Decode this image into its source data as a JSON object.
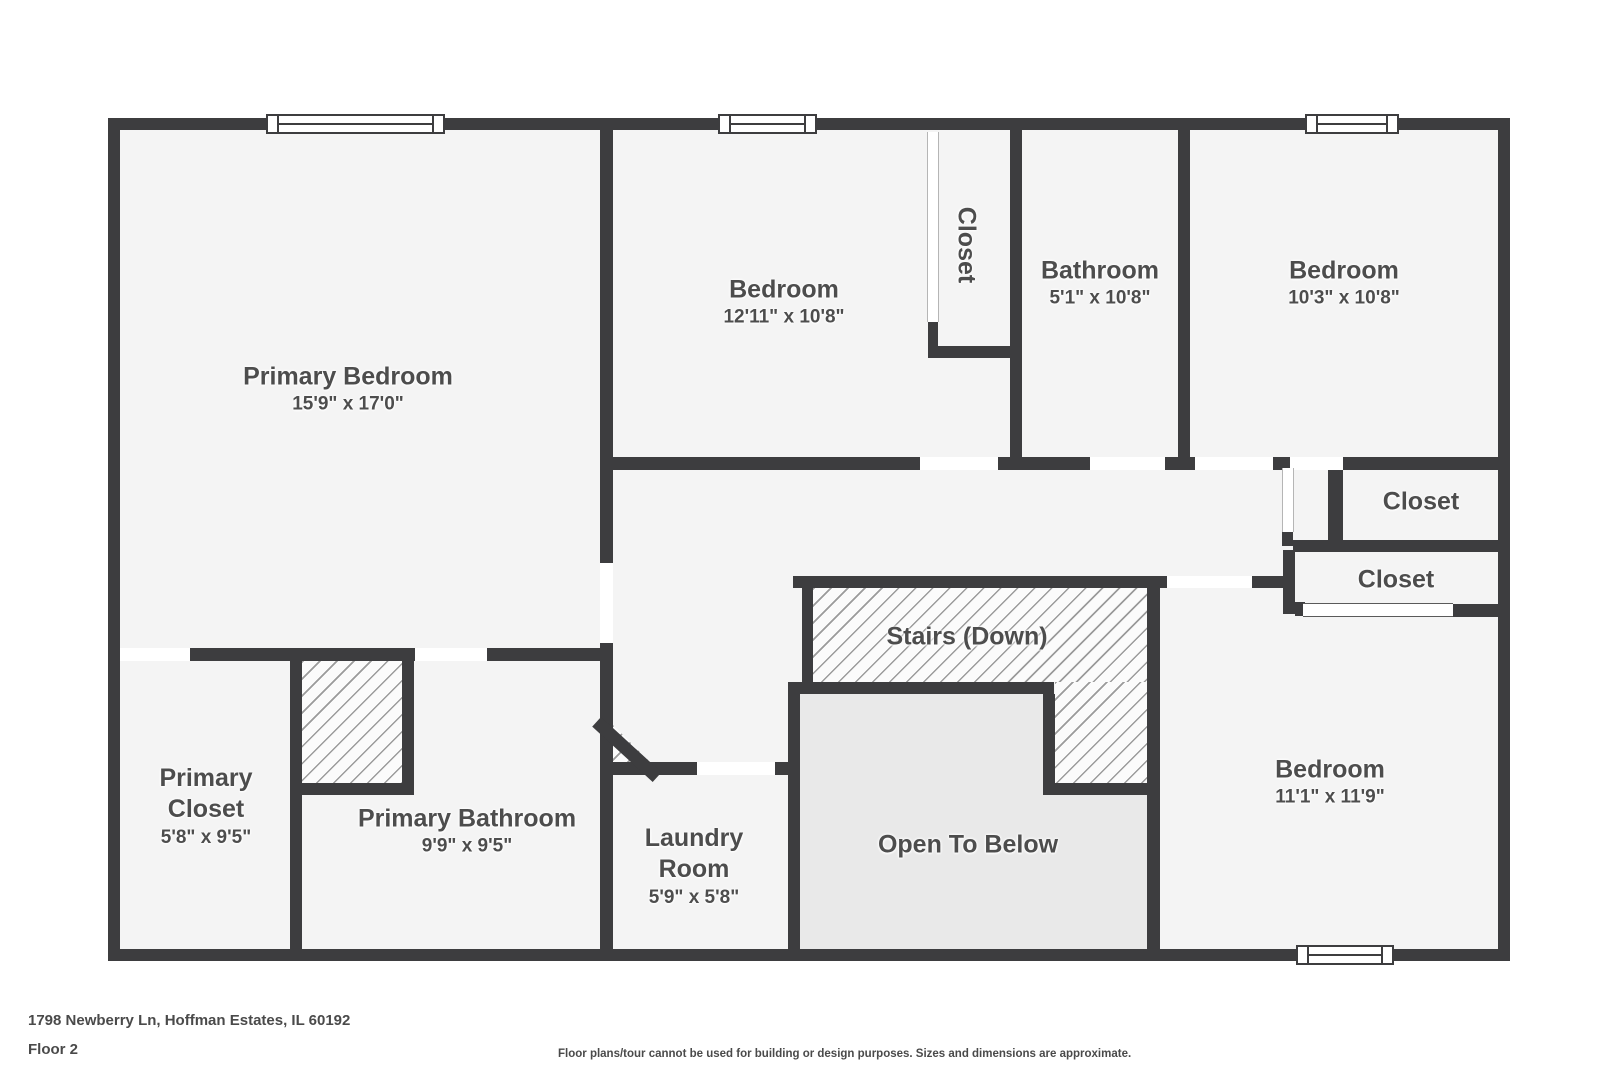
{
  "floorplan": {
    "rooms": [
      {
        "id": "primary-bedroom",
        "name": "Primary Bedroom",
        "dims": "15'9\" x 17'0\""
      },
      {
        "id": "bedroom-middle",
        "name": "Bedroom",
        "dims": "12'11\" x 10'8\""
      },
      {
        "id": "closet-top",
        "name": "Closet"
      },
      {
        "id": "bathroom",
        "name": "Bathroom",
        "dims": "5'1\" x 10'8\""
      },
      {
        "id": "bedroom-right",
        "name": "Bedroom",
        "dims": "10'3\" x 10'8\""
      },
      {
        "id": "closet-right-upper",
        "name": "Closet"
      },
      {
        "id": "closet-right-lower",
        "name": "Closet"
      },
      {
        "id": "stairs",
        "name": "Stairs (Down)"
      },
      {
        "id": "bedroom-bottom",
        "name": "Bedroom",
        "dims": "11'1\" x 11'9\""
      },
      {
        "id": "open-to-below",
        "name": "Open To Below"
      },
      {
        "id": "laundry",
        "name_lines": [
          "Laundry",
          "Room"
        ],
        "dims": "5'9\" x 5'8\""
      },
      {
        "id": "primary-closet",
        "name_lines": [
          "Primary",
          "Closet"
        ],
        "dims": "5'8\" x 9'5\""
      },
      {
        "id": "primary-bathroom",
        "name": "Primary Bathroom",
        "dims": "9'9\" x 9'5\""
      }
    ]
  },
  "footer": {
    "address": "1798 Newberry Ln, Hoffman Estates, IL 60192",
    "floor": "Floor 2",
    "disclaimer": "Floor plans/tour cannot be used for building or design purposes. Sizes and dimensions are approximate."
  },
  "colors": {
    "wall": "#3d3d3f",
    "room_fill": "#f4f4f4",
    "open_to_below_fill": "#e9e9e9",
    "hatch_line": "#9b9b9b",
    "label_text": "#4d4d4d"
  }
}
